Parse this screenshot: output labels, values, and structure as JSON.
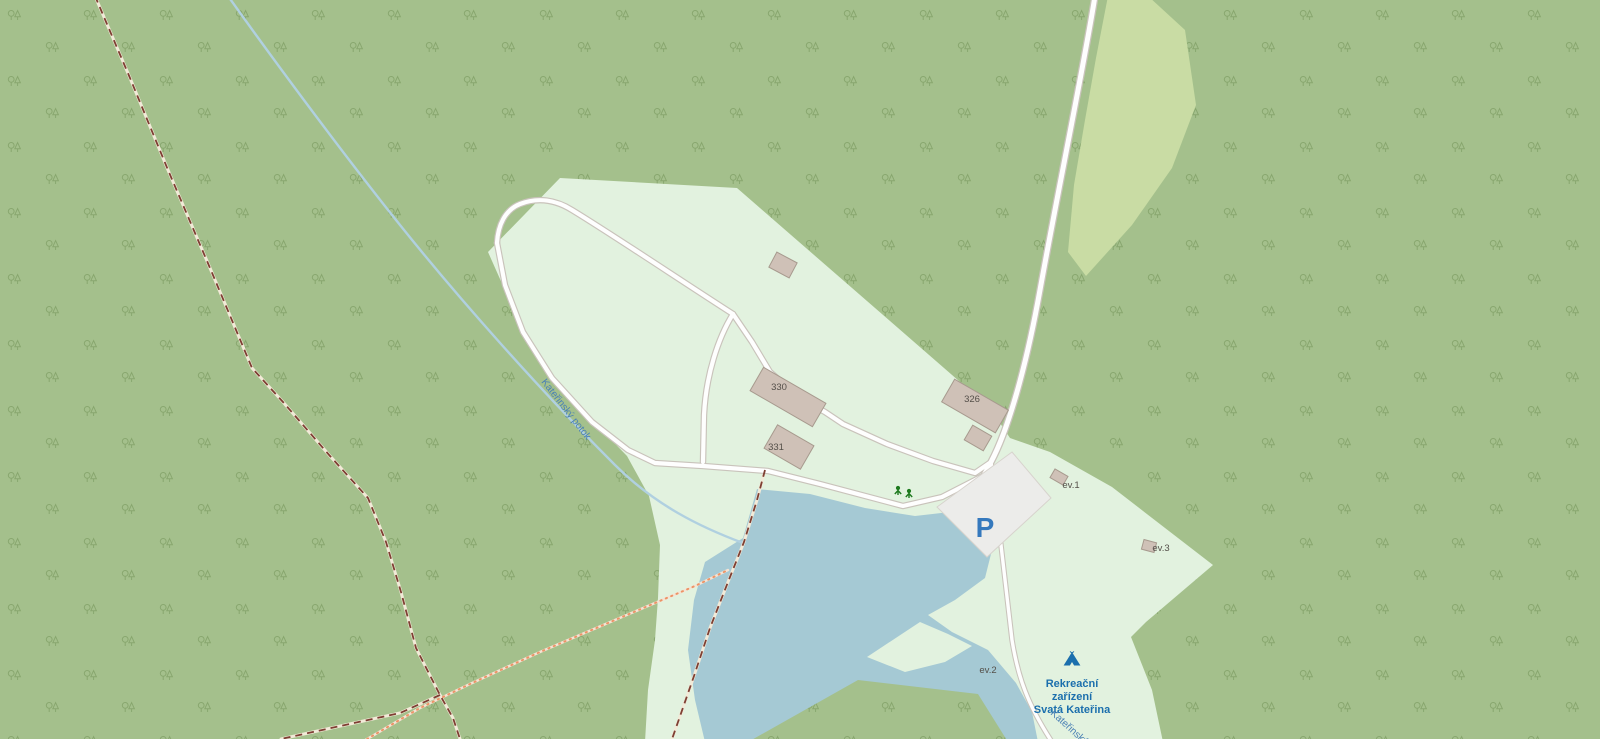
{
  "map": {
    "place_label": {
      "line1": "Rekreační",
      "line2": "zařízení",
      "line3": "Svatá Kateřina"
    },
    "stream_label": "Kateřinský potok",
    "stream_label_2": "Kateřinský potok",
    "parking_symbol": "P",
    "buildings": [
      {
        "label": "330"
      },
      {
        "label": "331"
      },
      {
        "label": "326"
      }
    ],
    "minor_buildings": [
      {
        "label": "ev.1"
      },
      {
        "label": "ev.2"
      },
      {
        "label": "ev.3"
      }
    ],
    "icons": [
      {
        "name": "campsite-tent"
      },
      {
        "name": "playground-trees"
      }
    ],
    "colors": {
      "forest": "#a4c08c",
      "clearing": "#e2f2df",
      "scrub": "#c9dca4",
      "water": "#a5c9d4",
      "road_fill": "#fefefe",
      "road_casing": "#c9c3bb",
      "parking_fill": "#ececea",
      "building_fill": "#cfc1b7",
      "building_stroke": "#a79a8e",
      "trail_dashed": "#7e3f33",
      "trail_dotted": "#ec9467",
      "poi_blue": "#1b6fad",
      "water_label_blue": "#4a80b5",
      "parking_blue": "#3579bd",
      "leisure_green": "#1e7a1e"
    }
  }
}
